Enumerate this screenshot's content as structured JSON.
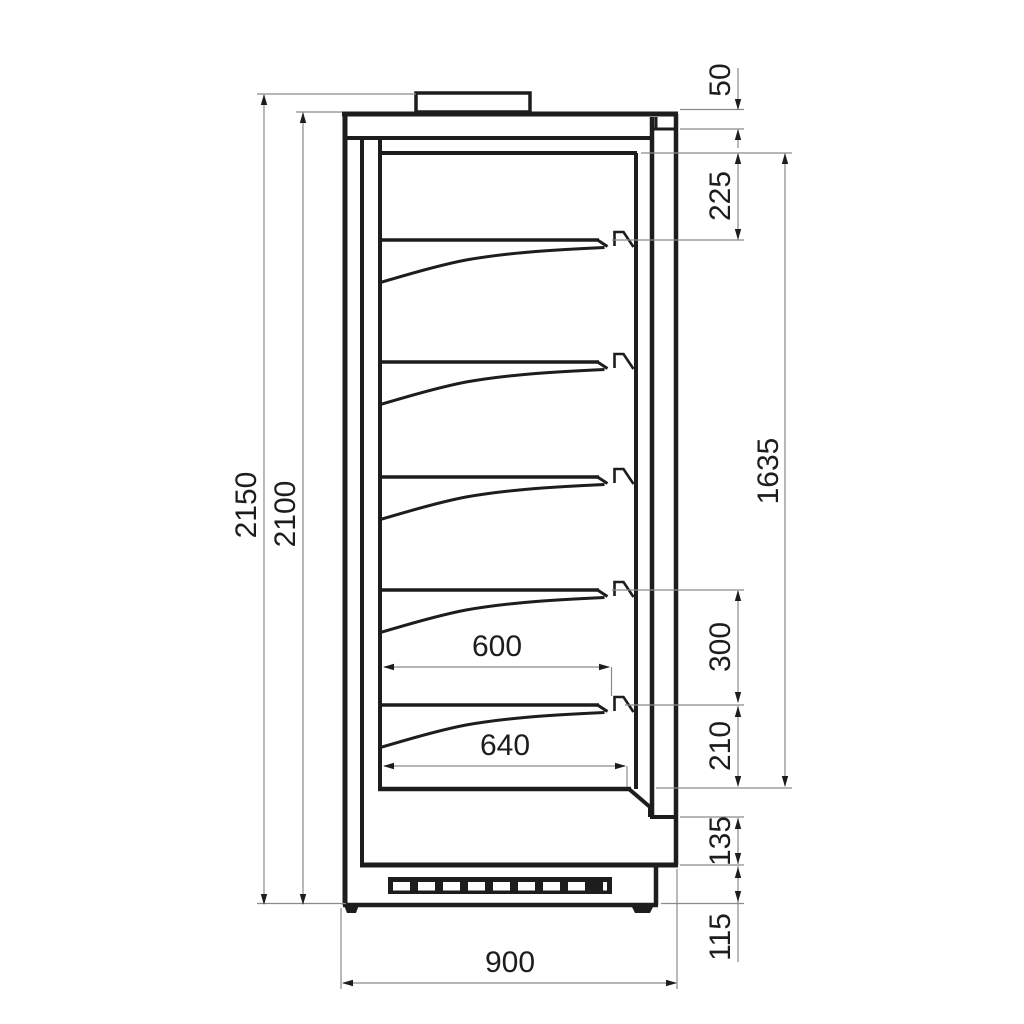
{
  "drawing": {
    "type": "technical-side-section",
    "subject": "refrigerated-display-cabinet-cross-section",
    "shelf_count": 5,
    "grille_slot_count": 8,
    "colors": {
      "background": "#ffffff",
      "outline": "#1d1d1b",
      "dimension_line": "#8a8a8a",
      "text": "#1d1d1b"
    }
  },
  "dimensions": {
    "left": [
      {
        "label": "2150"
      },
      {
        "label": "2100"
      }
    ],
    "right": [
      {
        "label": "50"
      },
      {
        "label": "225"
      },
      {
        "label": "1635"
      },
      {
        "label": "300"
      },
      {
        "label": "210"
      },
      {
        "label": "135"
      },
      {
        "label": "115"
      }
    ],
    "inner": [
      {
        "label": "600"
      },
      {
        "label": "640"
      }
    ],
    "bottom": [
      {
        "label": "900"
      }
    ]
  }
}
